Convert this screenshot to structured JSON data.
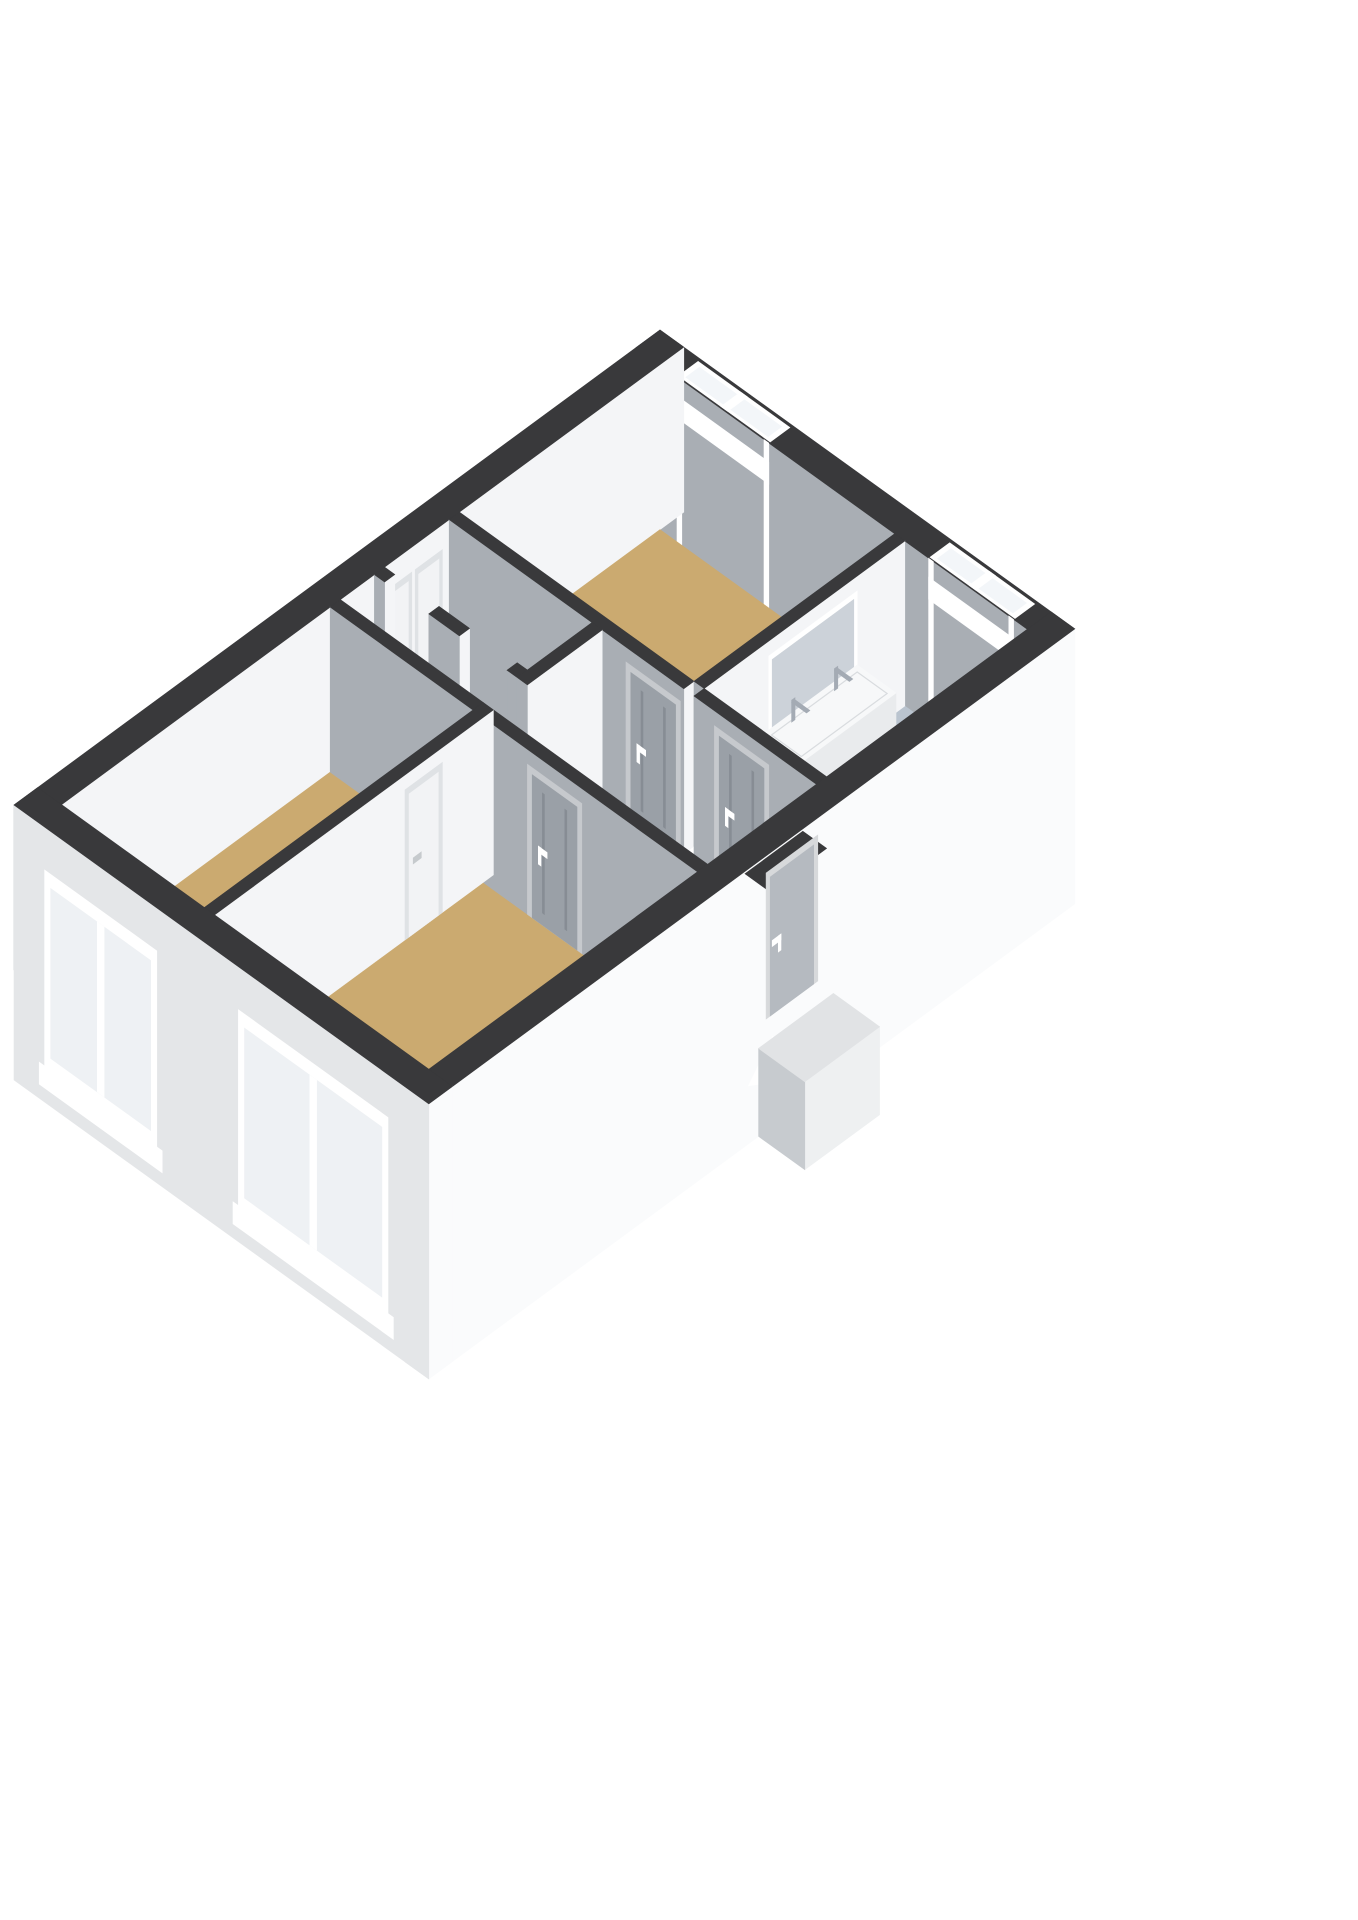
{
  "colors": {
    "bg": "#ffffff",
    "wall_top": "#39393b",
    "wall_side_light": "#f4f5f7",
    "wall_side_shadow": "#a9aeb4",
    "ext_outer_light": "#e4e6e8",
    "ext_outer_bright": "#fafbfc",
    "window_frame": "#ffffff",
    "window_glass": "#f3f6f9",
    "window_glass_outer": "#eef1f4",
    "door_gray": "#9aa0a7",
    "door_gray_frame": "#c6c9cd",
    "door_seam": "#878d94",
    "door_white": "#f2f3f5",
    "door_white_frame": "#dfe2e5",
    "door_entrance": "#b5bac0",
    "handle": "#ffffff",
    "handle_gray": "#c6cacd",
    "niche": "#ccd2d9",
    "vanity_top": "#f7f8f9",
    "vanity_front": "#e9ebed",
    "vanity_side": "#dde0e3",
    "chrome": "#a4abb4",
    "shower_tray": "#b0bac6",
    "shower_glass": "rgba(236,239,242,0.6)",
    "glass_edge": "#c6cbd1",
    "mixer": "#c9abab",
    "mixer_inner": "#efe7e7",
    "drain": "#97a1ac",
    "landing_top": "#e1e3e5",
    "landing_front": "#eef0f1",
    "landing_side": "#c7cbcf",
    "threshold": "#35363a",
    "rim": "#d9dcdf",
    "tray_line": "#9fabb8"
  },
  "rooms": [
    {
      "id": "bedroom-top",
      "floor_color": "#cbaa70"
    },
    {
      "id": "bathroom",
      "floor_color": "#bac4cf"
    },
    {
      "id": "storage-a",
      "floor_color": "#edeff1"
    },
    {
      "id": "storage-b",
      "floor_color": "#edeff1"
    },
    {
      "id": "hallway",
      "floor_color": "#cbaa70"
    },
    {
      "id": "bedroom-left",
      "floor_color": "#cbaa70"
    },
    {
      "id": "living-room",
      "floor_color": "#cbaa70"
    }
  ],
  "windows": [
    {
      "id": "window-bedroom-top",
      "panes": 2,
      "wall": "ne"
    },
    {
      "id": "window-bathroom",
      "panes": 2,
      "wall": "ne"
    },
    {
      "id": "window-bedroom-left",
      "panes": 2,
      "wall": "sw"
    },
    {
      "id": "window-living-room",
      "panes": 2,
      "wall": "sw"
    }
  ],
  "doors": [
    {
      "id": "door-bedroom-top",
      "style": "gray"
    },
    {
      "id": "door-bathroom",
      "style": "gray"
    },
    {
      "id": "door-living-room",
      "style": "gray"
    },
    {
      "id": "door-bedroom-left",
      "style": "white"
    },
    {
      "id": "door-entrance",
      "style": "entrance"
    },
    {
      "id": "closet-door-a",
      "style": "white"
    },
    {
      "id": "closet-door-b",
      "style": "white"
    }
  ],
  "fixtures": [
    {
      "id": "vanity-double-sink"
    },
    {
      "id": "shower"
    },
    {
      "id": "shower-mixer"
    },
    {
      "id": "entry-landing"
    }
  ]
}
